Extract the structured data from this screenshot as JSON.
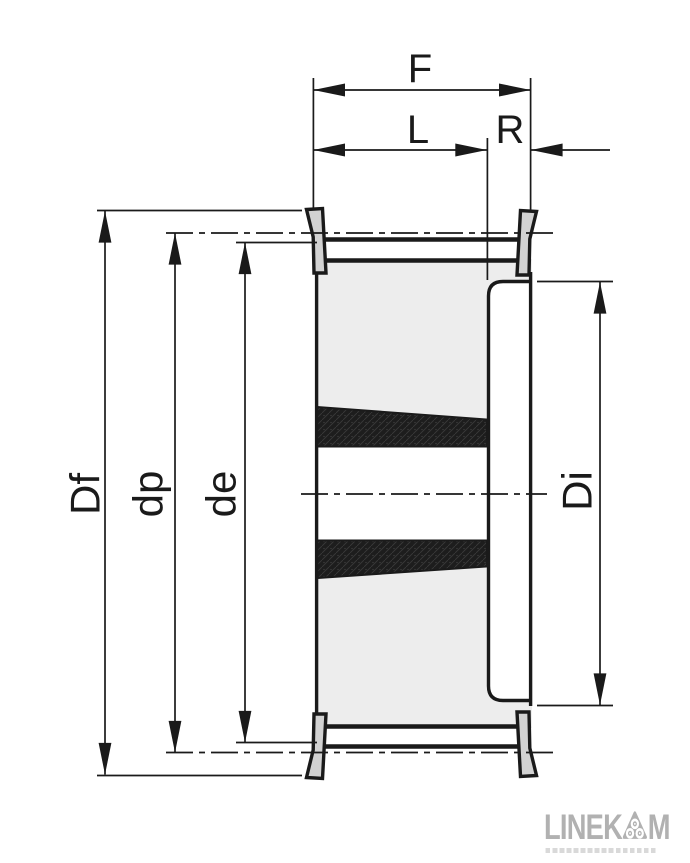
{
  "dimensions": {
    "F": "F",
    "L": "L",
    "R": "R",
    "Df": "Df",
    "dp": "dp",
    "de": "de",
    "Di": "Di"
  },
  "logo": {
    "brand_left": "LINEK",
    "brand_right": "M",
    "badge_icon": "rounded-triangle-with-three-rollers"
  },
  "colors": {
    "line": "#1a1a1a",
    "body_fill": "#ededed",
    "flange_fill": "#d2d2d2",
    "bush_section_fill": "#1d1d1d",
    "logo_gray": "#b1b1b1"
  }
}
